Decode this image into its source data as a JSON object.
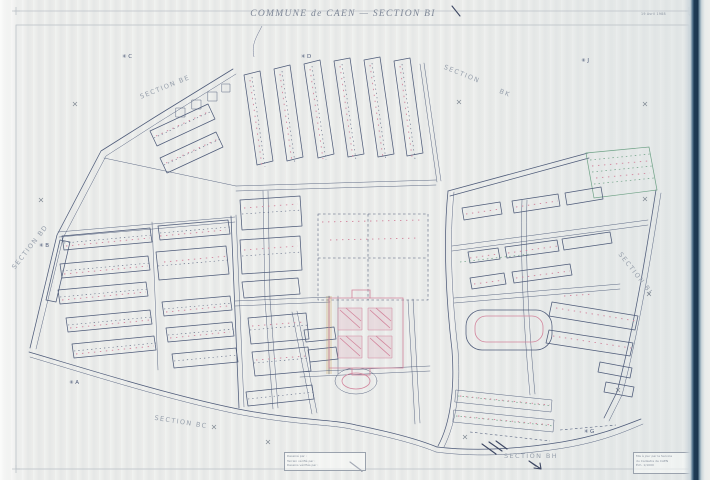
{
  "document": {
    "title": "COMMUNE de CAEN  —  SECTION BI",
    "date_note": "19 Avril 1988"
  },
  "map": {
    "cross_glyph": "×",
    "star_glyph": "✳",
    "section_labels": [
      {
        "text": "SECTION BE",
        "x": 165,
        "y": 87,
        "rot": -22
      },
      {
        "text": "SECTION",
        "x": 462,
        "y": 74,
        "rot": 22
      },
      {
        "text": "BK",
        "x": 505,
        "y": 93,
        "rot": 22
      },
      {
        "text": "SECTION BD",
        "x": 30,
        "y": 247,
        "rot": -52
      },
      {
        "text": "SECTION BL",
        "x": 636,
        "y": 274,
        "rot": 52
      },
      {
        "text": "SECTION BC",
        "x": 181,
        "y": 422,
        "rot": 9
      },
      {
        "text": "SECTION BH",
        "x": 531,
        "y": 456,
        "rot": 0
      }
    ],
    "star_marks": [
      {
        "letter": "C",
        "x": 127,
        "y": 57
      },
      {
        "letter": "D",
        "x": 306,
        "y": 57
      },
      {
        "letter": "J",
        "x": 585,
        "y": 61
      },
      {
        "letter": "B",
        "x": 44,
        "y": 246
      },
      {
        "letter": "A",
        "x": 74,
        "y": 383
      },
      {
        "letter": "G",
        "x": 589,
        "y": 432
      }
    ],
    "crosses": [
      [
        75,
        104
      ],
      [
        459,
        102
      ],
      [
        645,
        104
      ],
      [
        41,
        200
      ],
      [
        645,
        199
      ],
      [
        649,
        294
      ],
      [
        618,
        390
      ],
      [
        214,
        427
      ],
      [
        268,
        442
      ],
      [
        465,
        437
      ]
    ]
  },
  "legend_box": {
    "lines": [
      "Dessiné par :",
      "Terrain vérifié par :",
      "Dessins vérifiés par :"
    ]
  },
  "stamp_box": {
    "lines": [
      "Mis à jour par le Service",
      "du Cadastre de CAEN",
      "Éch. 1/1000"
    ]
  }
}
